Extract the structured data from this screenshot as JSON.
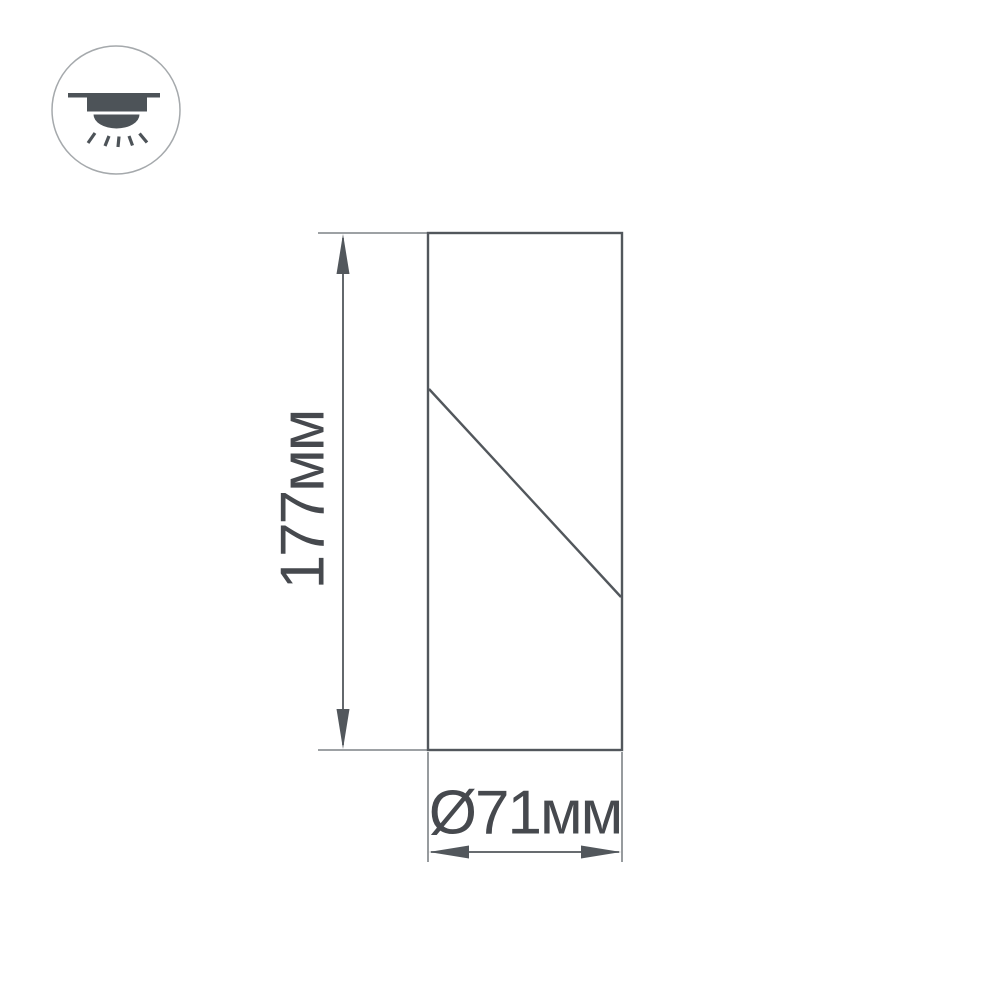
{
  "page": {
    "background": "#ffffff"
  },
  "icon": {
    "name": "ceiling-mounted-light",
    "color": "#4d5358",
    "ring_color": "#a5a9ac"
  },
  "drawing": {
    "line_color": "#52575c",
    "extension_line_color": "#7d8286",
    "text_color": "#46494e",
    "height_label": "177мм",
    "diameter_label": "Ø71мм"
  }
}
